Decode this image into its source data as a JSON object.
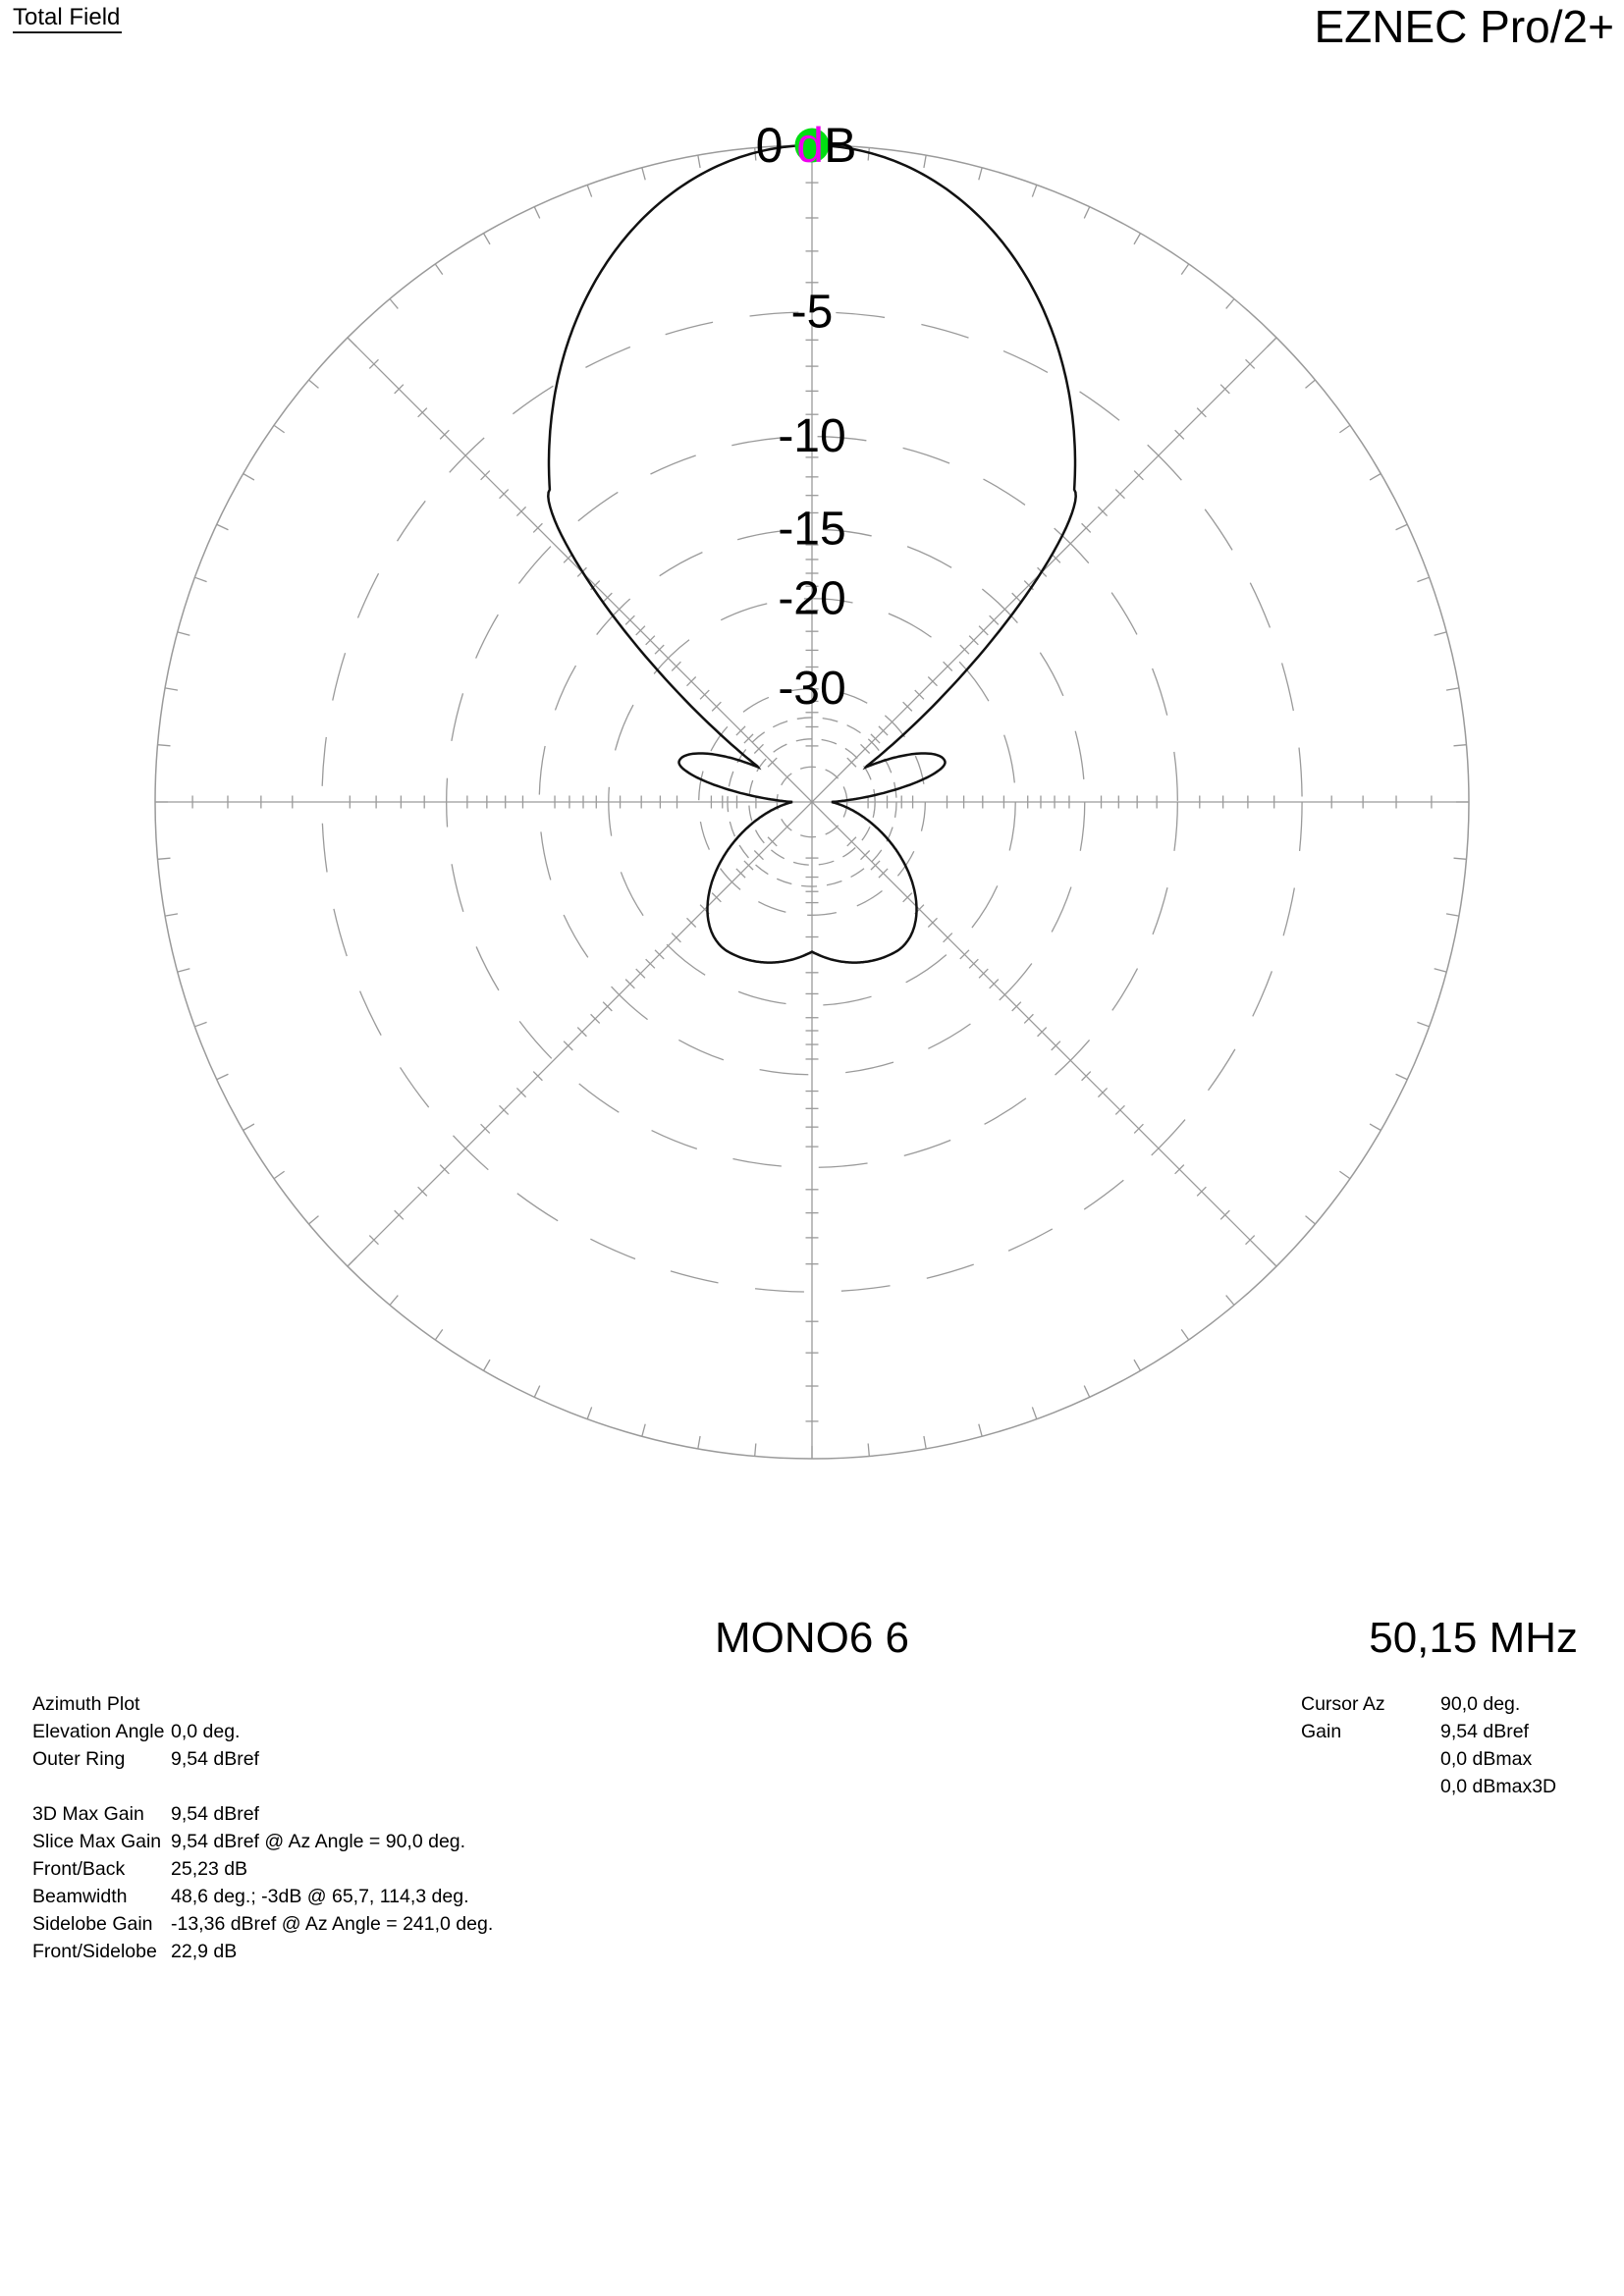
{
  "window": {
    "field_type_label": "Total Field",
    "app_title": "EZNEC Pro/2+"
  },
  "plot_footer": {
    "model_name": "MONO6 6",
    "frequency": "50,15 MHz"
  },
  "info_left": {
    "title": "Azimuth Plot",
    "rows": [
      {
        "label": "Elevation Angle",
        "value": "0,0 deg."
      },
      {
        "label": "Outer Ring",
        "value": "9,54 dBref"
      },
      {
        "label": "",
        "value": ""
      },
      {
        "label": "3D Max Gain",
        "value": "9,54 dBref"
      },
      {
        "label": "Slice Max Gain",
        "value": "9,54 dBref @ Az Angle = 90,0 deg."
      },
      {
        "label": "Front/Back",
        "value": "25,23 dB"
      },
      {
        "label": "Beamwidth",
        "value": "48,6 deg.; -3dB @ 65,7, 114,3 deg."
      },
      {
        "label": "Sidelobe Gain",
        "value": "-13,36 dBref @ Az Angle = 241,0 deg."
      },
      {
        "label": "Front/Sidelobe",
        "value": "22,9 dB"
      }
    ]
  },
  "info_right": {
    "rows": [
      {
        "label": "Cursor Az",
        "value": "90,0 deg."
      },
      {
        "label": "Gain",
        "value": "9,54 dBref"
      },
      {
        "label": "",
        "value": "0,0 dBmax"
      },
      {
        "label": "",
        "value": "0,0 dBmax3D"
      }
    ]
  },
  "chart_data": {
    "type": "polar",
    "title": "Total Field azimuth radiation pattern",
    "units": "dB relative to outer ring (outer ring = 9,54 dBref = 0,0 dBmax)",
    "radial_scale": {
      "type": "ARRL-log",
      "k_per_dB": 0.0586,
      "outer_ring_dB": 0
    },
    "labeled_rings": [
      {
        "dB": -5,
        "label": "-5"
      },
      {
        "dB": -10,
        "label": "-10"
      },
      {
        "dB": -15,
        "label": "-15"
      },
      {
        "dB": -20,
        "label": "-20"
      },
      {
        "dB": -30,
        "label": "-30"
      }
    ],
    "minor_rings_dB": [
      -35,
      -40,
      -50
    ],
    "spoke_step_deg": 45,
    "azimuth_tick_step_deg": 5,
    "db_tick_levels": [
      1,
      2,
      3,
      4,
      6,
      7,
      8,
      9,
      11,
      12,
      13,
      14,
      16,
      17,
      18,
      19,
      21,
      23,
      25,
      27,
      32,
      34,
      37,
      42
    ],
    "peak_label": {
      "parts": [
        "0 ",
        "d",
        "B"
      ],
      "highlight_index": 1
    },
    "cursor": {
      "az_deg": 90,
      "gain_dBmax": 0.0,
      "gain_dBref": 9.54
    },
    "pattern_model": {
      "main_lobe_az_deg": 90,
      "hpbw_deg": 48.6,
      "hpbw_edges_az_deg": [
        65.7,
        114.3
      ],
      "gauss_limit_deg": 40,
      "shoulder_exp": 1.7,
      "null_offset_deg": 57,
      "null_level_dB": -40,
      "sidelobe_offset_deg": 73,
      "sidelobe_level_dB": -26.5,
      "sidelobe_halfwidth_in_deg": 16,
      "sidelobe_halfwidth_out_deg": 17,
      "pinch_level_dB": -60,
      "backlobe_hump_offset_deg": 29,
      "backlobe_span_deg": 61,
      "backlobe_hump_level_dB": -22.9,
      "rear_level_dB": -25.23,
      "front_back_dB": 25.23,
      "front_sidelobe_dB": 22.9,
      "sidelobe_az_deg": 241.0
    },
    "colors": {
      "grid": "#9a9a9a",
      "pattern": "#111111",
      "cursor_marker": "#00dd12",
      "highlight_text": "#ee00ee",
      "label_text": "#000000"
    }
  }
}
